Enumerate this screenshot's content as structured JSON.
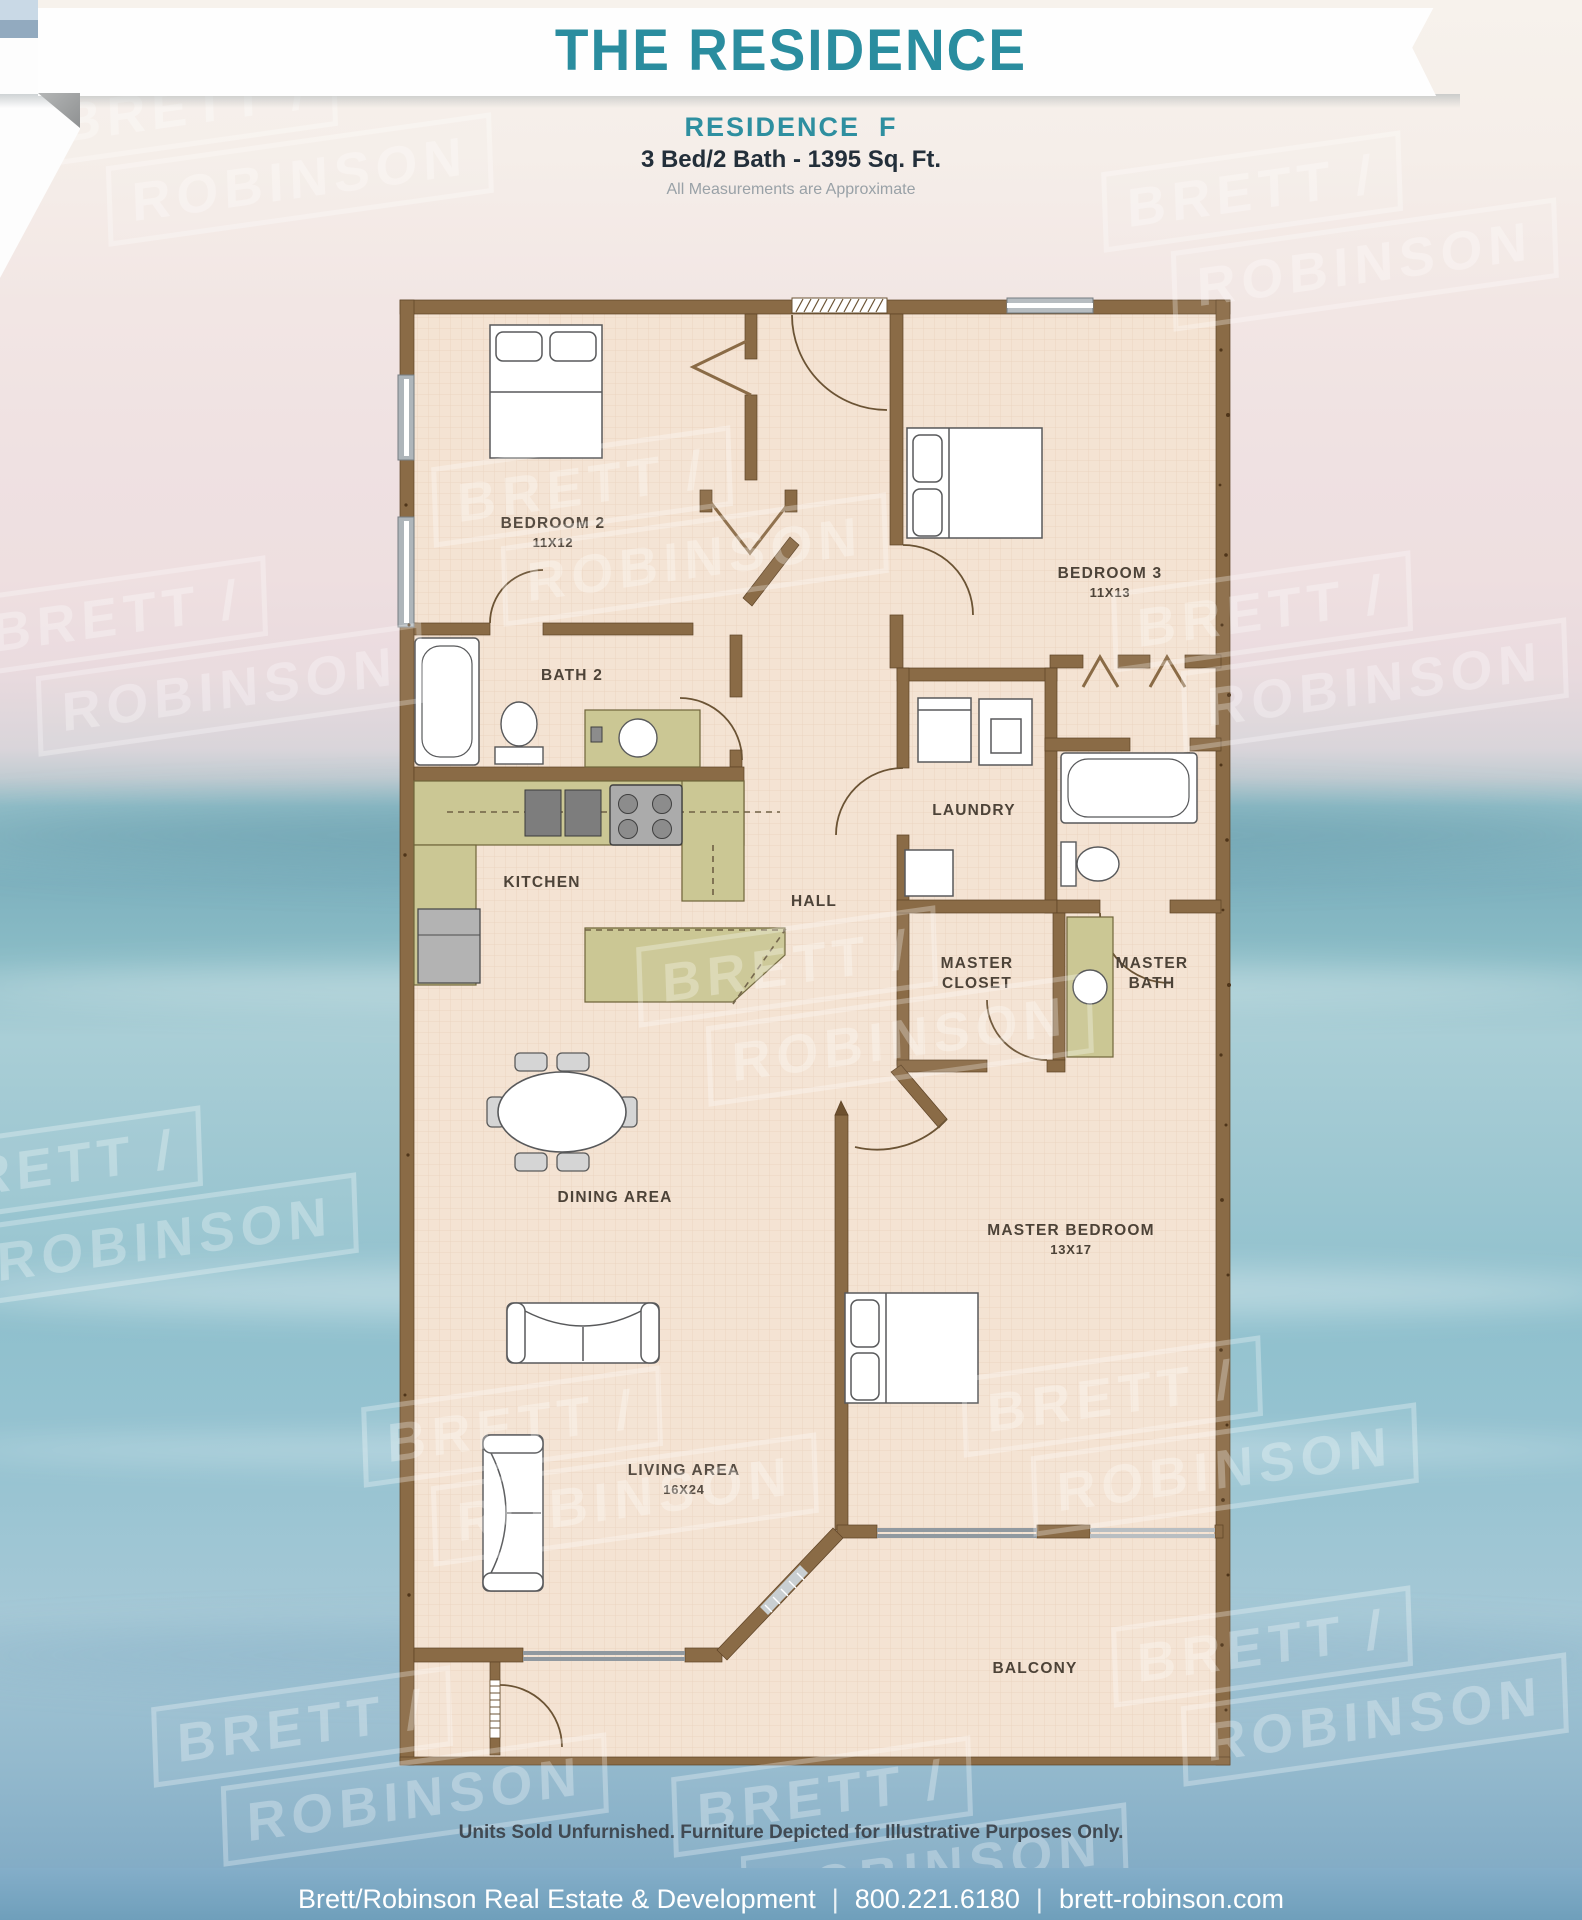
{
  "header": {
    "title": "THE RESIDENCE"
  },
  "subtitle": {
    "residence": "RESIDENCE  F",
    "specs": "3 Bed/2 Bath - 1395 Sq. Ft.",
    "note": "All Measurements are Approximate"
  },
  "floorplan": {
    "rooms": {
      "bedroom2": {
        "name": "BEDROOM 2",
        "dims": "11X12"
      },
      "bedroom3": {
        "name": "BEDROOM 3",
        "dims": "11X13"
      },
      "bath2": {
        "name": "BATH 2"
      },
      "kitchen": {
        "name": "KITCHEN"
      },
      "hall": {
        "name": "HALL"
      },
      "laundry": {
        "name": "LAUNDRY"
      },
      "master_closet": {
        "line1": "MASTER",
        "line2": "CLOSET"
      },
      "master_bath": {
        "line1": "MASTER",
        "line2": "BATH"
      },
      "dining": {
        "name": "DINING AREA"
      },
      "living": {
        "name": "LIVING AREA",
        "dims": "16X24"
      },
      "master_bedroom": {
        "name": "MASTER BEDROOM",
        "dims": "13X17"
      },
      "balcony": {
        "name": "BALCONY"
      }
    }
  },
  "disclaimer": "Units Sold Unfurnished. Furniture Depicted for Illustrative Purposes Only.",
  "footer": {
    "company": "Brett/Robinson Real Estate & Development",
    "phone": "800.221.6180",
    "website": "brett-robinson.com",
    "separator": "|"
  },
  "watermark": {
    "line1": "BRETT /",
    "line2": "ROBINSON"
  },
  "colors": {
    "accent_teal": "#2e8fa0",
    "wall_brown": "#8a6b46",
    "floor_tan": "#f3e2d2",
    "counter_olive": "#cbc794",
    "footer_blue": "#7fa9c4"
  }
}
